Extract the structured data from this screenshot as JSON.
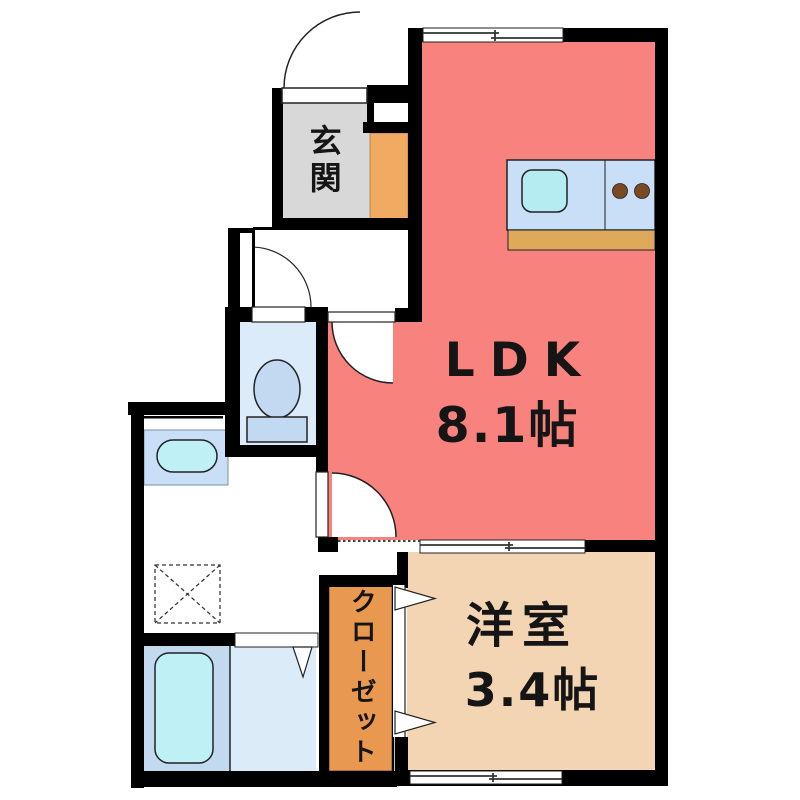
{
  "floorplan": {
    "rooms": {
      "entrance": {
        "label": "玄関"
      },
      "ldk": {
        "label": "LDK",
        "size": "8.1帖"
      },
      "western_room": {
        "label": "洋室",
        "size": "3.4帖"
      },
      "closet": {
        "label": "クローゼット"
      }
    },
    "colors": {
      "wall": "#000000",
      "ldk": "#F8827E",
      "western_room": "#F3D5B4",
      "entrance": "#D8D8D8",
      "closet": "#E8994F",
      "shoe_cabinet": "#F0AA62",
      "counter_blue": "#C9DFF7",
      "sink_cyan": "#B5ECF2",
      "basin_cyan": "#BFF0F5",
      "counter_wood": "#DFA95C",
      "burner_brown": "#7A4A22",
      "toilet_room": "#DCEBFA",
      "toilet_fixture": "#C3D9F2",
      "bath_mat": "#C3D9F0",
      "bath_right": "#DCEBF8"
    }
  }
}
